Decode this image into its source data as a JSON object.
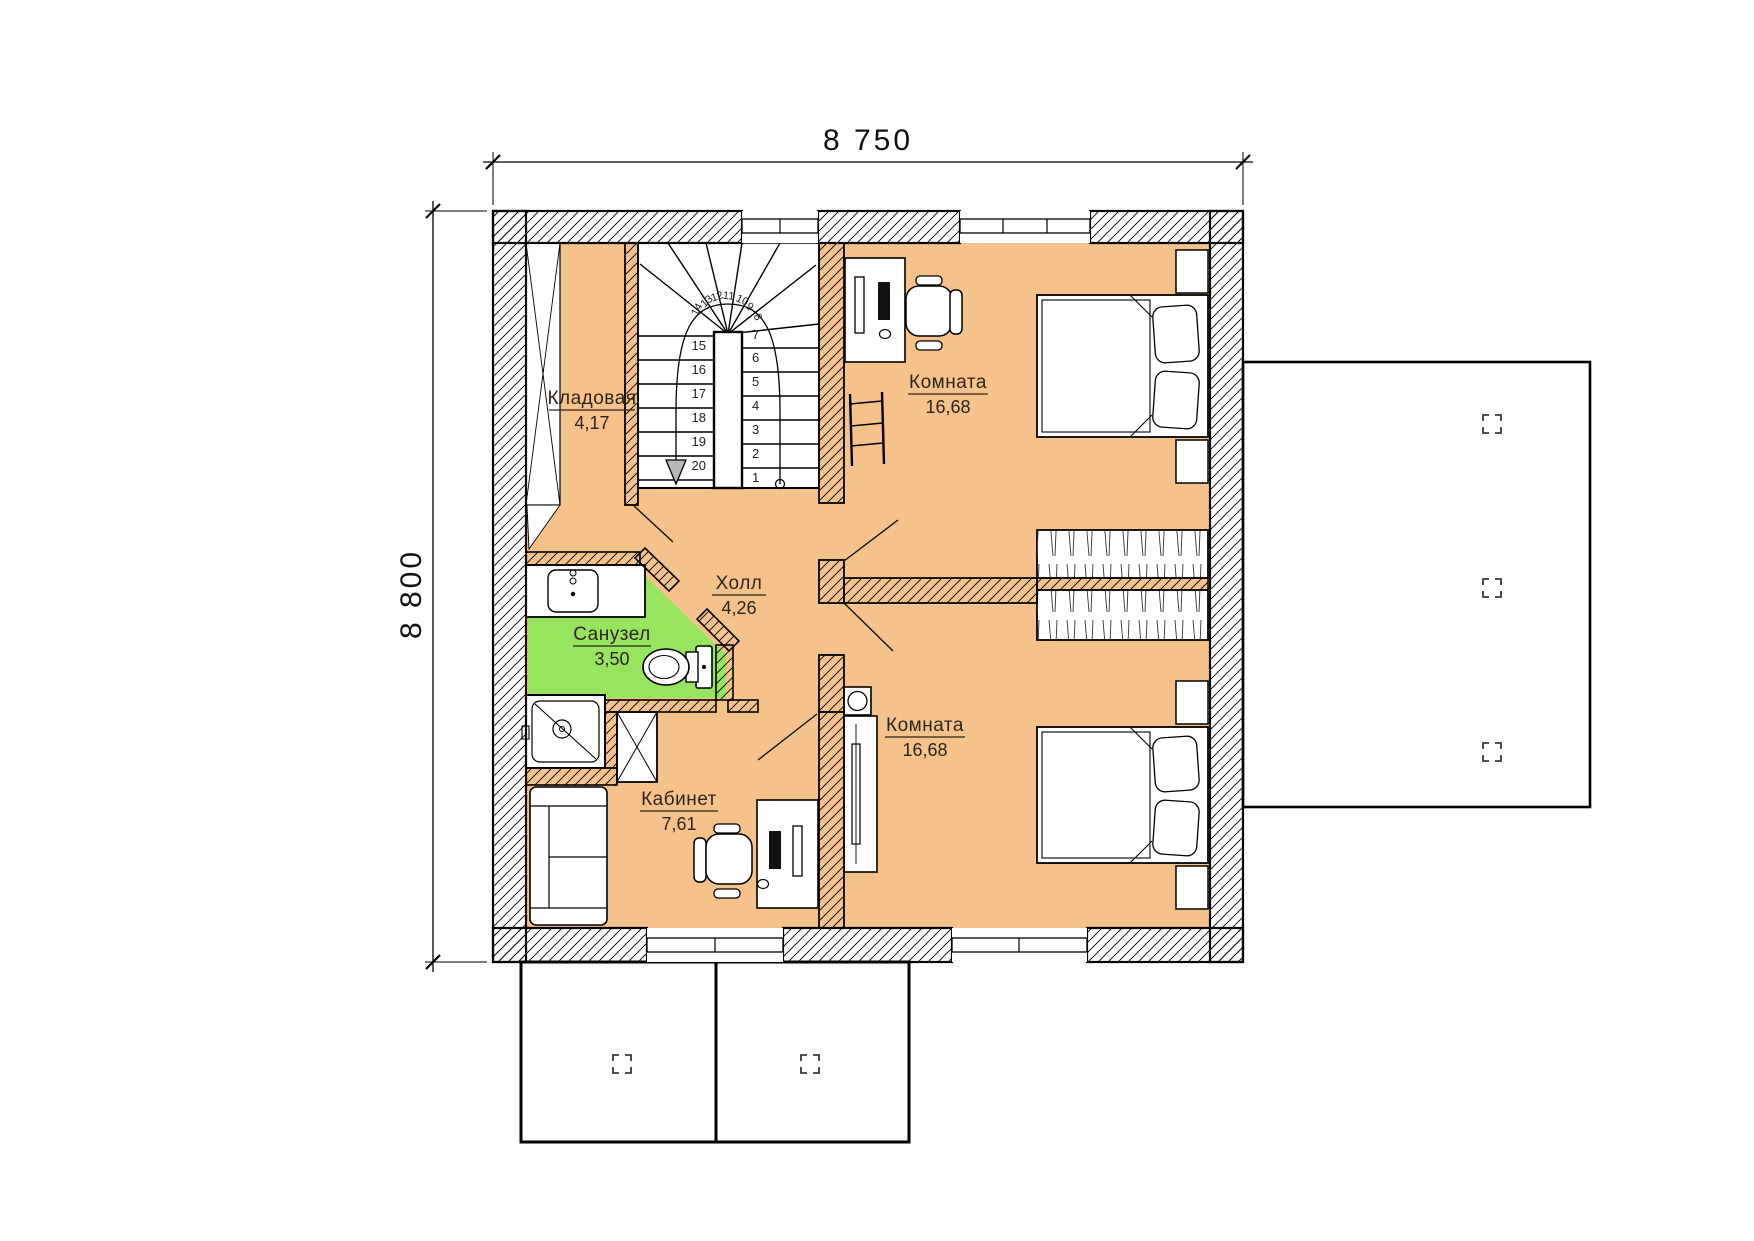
{
  "dimensions": {
    "width_label": "8 750",
    "height_label": "8 800"
  },
  "rooms": {
    "storage": {
      "name": "Кладовая",
      "area": "4,17"
    },
    "bedroom_top": {
      "name": "Комната",
      "area": "16,68"
    },
    "hall": {
      "name": "Холл",
      "area": "4,26"
    },
    "bathroom": {
      "name": "Санузел",
      "area": "3,50"
    },
    "office": {
      "name": "Кабинет",
      "area": "7,61"
    },
    "bedroom_bottom": {
      "name": "Комната",
      "area": "16,68"
    }
  },
  "stairs": {
    "right_flight": [
      "1",
      "2",
      "3",
      "4",
      "5",
      "6",
      "7"
    ],
    "winders": [
      "8",
      "9",
      "10",
      "11",
      "12",
      "13",
      "14"
    ],
    "left_flight": [
      "15",
      "16",
      "17",
      "18",
      "19",
      "20"
    ]
  },
  "colors": {
    "floor": "#F6C28B",
    "bathroom": "#97E45F",
    "wall_line": "#000000"
  }
}
